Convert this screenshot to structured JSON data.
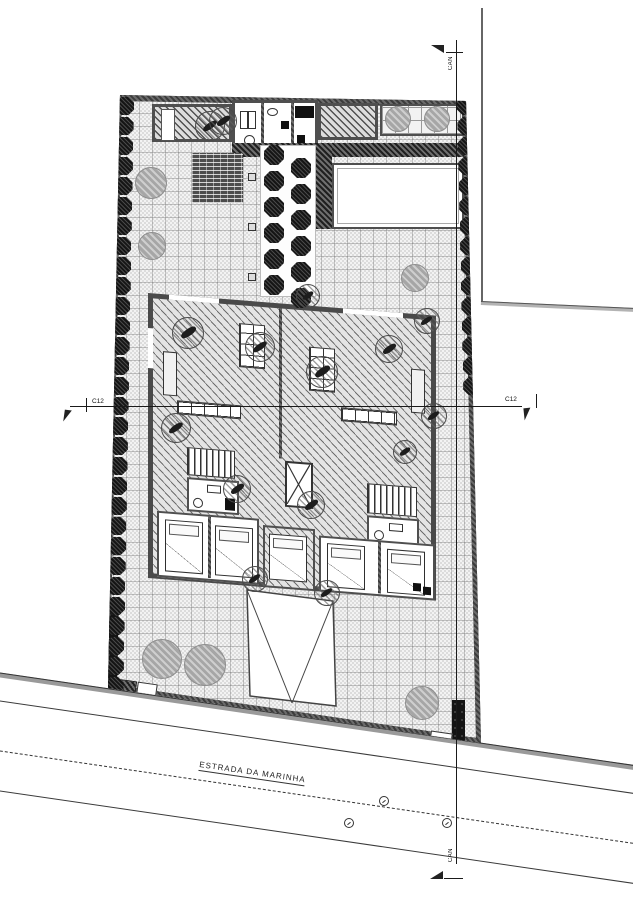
{
  "labels": {
    "road_name": "ESTRADA DA MARINHA",
    "section_c12": "C12",
    "section_can": "CAN"
  },
  "colors": {
    "wall": "#4f4f4f",
    "paving": "#ececec",
    "hatch_line": "#5a5a5a",
    "tree_dark": "#151515",
    "tree_gray": "#a6a6a6",
    "band_dark": "#1f1f1f",
    "line": "#1a1a1a"
  },
  "vegetation": {
    "boundary_rows": [
      {
        "side": "left",
        "x": 25,
        "x_drift": -0.018,
        "y_start": 18,
        "y_end": 598,
        "spacing": 20,
        "r": 9
      },
      {
        "side": "right",
        "x": 366,
        "x_drift": 0.022,
        "y_start": 18,
        "y_end": 300,
        "spacing": 20,
        "r": 9
      }
    ],
    "pergola_rows": [
      {
        "x": 174,
        "y_start": 67,
        "count": 6,
        "spacing": 26,
        "r": 10
      },
      {
        "x": 201,
        "y_start": 80,
        "count": 6,
        "spacing": 26,
        "r": 10
      }
    ],
    "gray_trees": [
      {
        "x": 51,
        "y": 95,
        "r": 16
      },
      {
        "x": 52,
        "y": 158,
        "r": 14
      },
      {
        "x": 315,
        "y": 190,
        "r": 14
      },
      {
        "x": 298,
        "y": 31,
        "r": 13
      },
      {
        "x": 337,
        "y": 31,
        "r": 13
      },
      {
        "x": 62,
        "y": 571,
        "r": 20
      },
      {
        "x": 105,
        "y": 577,
        "r": 21
      },
      {
        "x": 322,
        "y": 615,
        "r": 17
      }
    ],
    "hatched_trees": [
      {
        "x": 88,
        "y": 245,
        "r": 16
      },
      {
        "x": 160,
        "y": 259,
        "r": 15
      },
      {
        "x": 222,
        "y": 284,
        "r": 16
      },
      {
        "x": 289,
        "y": 261,
        "r": 14
      },
      {
        "x": 76,
        "y": 340,
        "r": 15
      },
      {
        "x": 137,
        "y": 401,
        "r": 14
      },
      {
        "x": 211,
        "y": 417,
        "r": 14
      },
      {
        "x": 155,
        "y": 491,
        "r": 13
      },
      {
        "x": 227,
        "y": 505,
        "r": 13
      },
      {
        "x": 327,
        "y": 233,
        "r": 13
      },
      {
        "x": 334,
        "y": 328,
        "r": 13
      },
      {
        "x": 305,
        "y": 364,
        "r": 12
      },
      {
        "x": 208,
        "y": 208,
        "r": 12
      },
      {
        "x": 110,
        "y": 38,
        "r": 15
      },
      {
        "x": 123,
        "y": 33,
        "r": 14
      }
    ]
  },
  "road": {
    "manholes": [
      {
        "x": 384,
        "y": 801
      },
      {
        "x": 349,
        "y": 823
      },
      {
        "x": 447,
        "y": 823
      }
    ]
  }
}
